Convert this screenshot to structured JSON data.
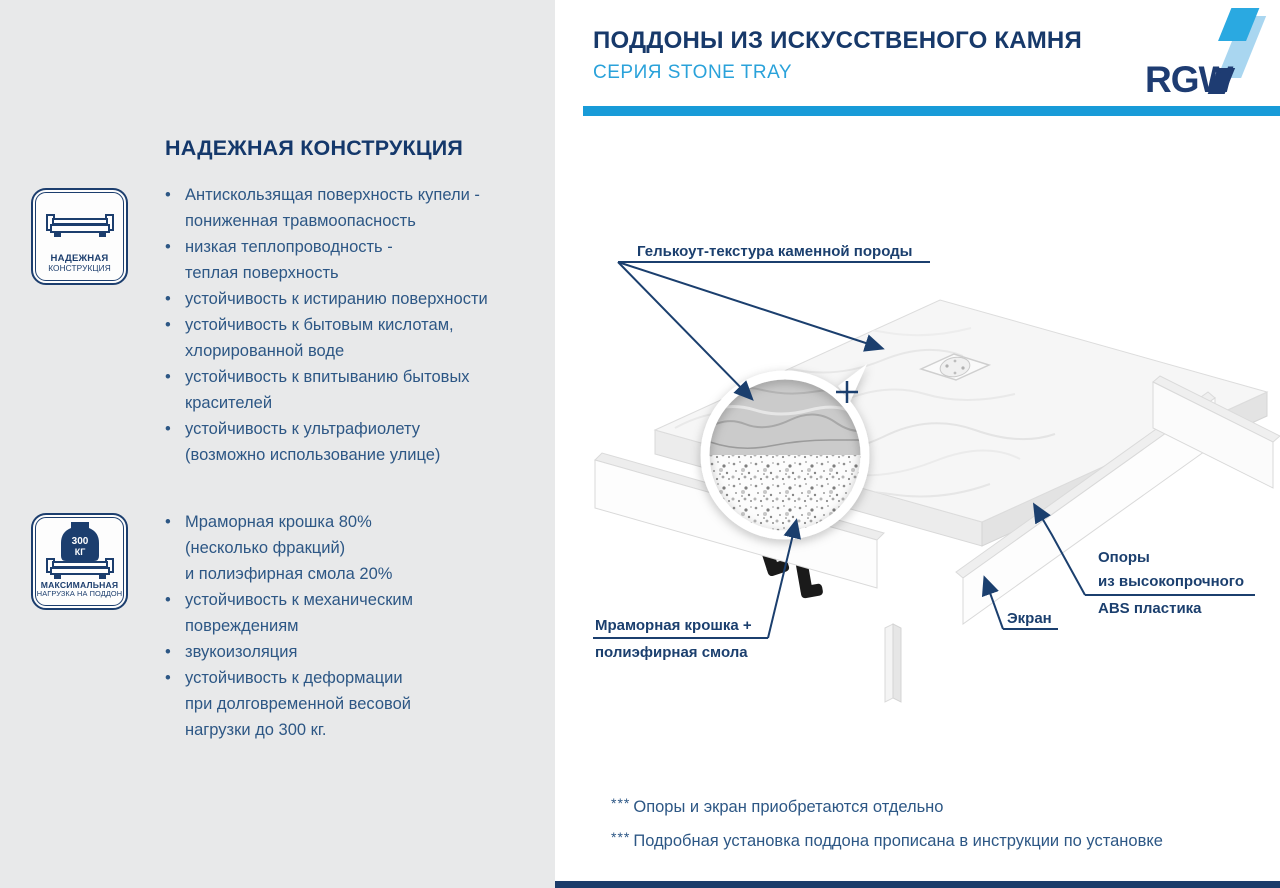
{
  "page": {
    "title": "ПОДДОНЫ ИЗ ИСКУССТВЕНОГО КАМНЯ",
    "subtitle": "СЕРИЯ STONE TRAY",
    "brand": "RGW"
  },
  "left": {
    "heading": "НАДЕЖНАЯ КОНСТРУКЦИЯ",
    "bullet": "•",
    "badge_construction": {
      "line1": "НАДЕЖНАЯ",
      "line2": "КОНСТРУКЦИЯ"
    },
    "badge_load": {
      "weight_value": "300",
      "weight_unit": "КГ",
      "line1": "МАКСИМАЛЬНАЯ",
      "line2": "НАГРУЗКА НА ПОДДОН"
    },
    "list1": [
      [
        "Антискользящая поверхность купели -",
        "пониженная травмоопасность"
      ],
      [
        "низкая теплопроводность -",
        "теплая поверхность"
      ],
      [
        "устойчивость к истиранию поверхности"
      ],
      [
        "устойчивость к бытовым кислотам,",
        "хлорированной воде"
      ],
      [
        "устойчивость к впитыванию бытовых",
        "красителей"
      ],
      [
        "устойчивость к ультрафиолету",
        "(возможно использование улице)"
      ]
    ],
    "list2": [
      [
        "Мраморная крошка 80%",
        "(несколько фракций)",
        "и полиэфирная смола 20%"
      ],
      [
        "устойчивость к механическим",
        "повреждениям"
      ],
      [
        "звукоизоляция"
      ],
      [
        "устойчивость к деформации",
        "при долговременной весовой",
        "нагрузки до 300 кг."
      ]
    ]
  },
  "diagram": {
    "gelcoat_label": "Гелькоут-текстура каменной породы",
    "marble_label": [
      "Мраморная крошка +",
      "полиэфирная смола"
    ],
    "screen_label": "Экран",
    "supports_label": [
      "Опоры",
      "из высокопрочного",
      "ABS пластика"
    ],
    "plus": "+"
  },
  "footnotes": [
    {
      "marker": "***",
      "text": "Опоры и экран приобретаются отдельно"
    },
    {
      "marker": "***",
      "text": "Подробная установка поддона прописана в инструкции по установке"
    }
  ],
  "colors": {
    "navy": "#17396a",
    "label_navy": "#1b3f6e",
    "accent_blue": "#189bd8",
    "subtitle_blue": "#2aa2da",
    "body_text": "#2d5785",
    "panel_gray": "#e8e9ea",
    "bottom_bar": "#1b3c6a"
  }
}
